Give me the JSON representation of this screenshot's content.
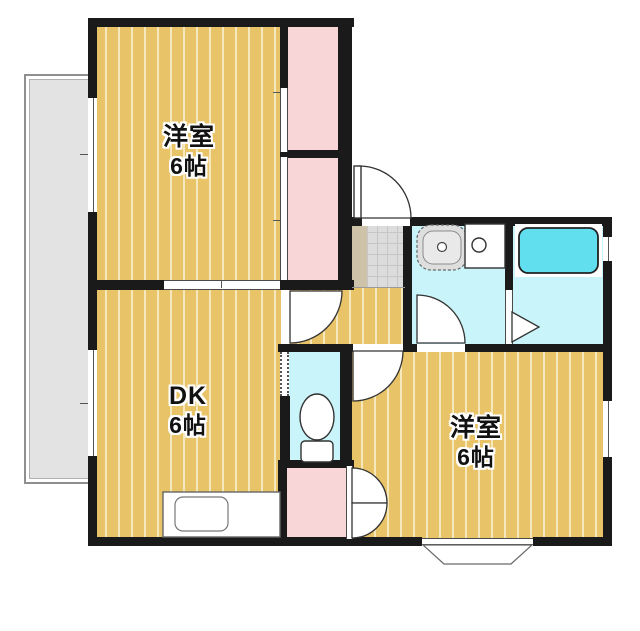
{
  "rooms": {
    "west_room_top": {
      "label": "洋室",
      "size": "6帖"
    },
    "dining_kitchen": {
      "label": "DK",
      "size": "6帖"
    },
    "west_room_bottom": {
      "label": "洋室",
      "size": "6帖"
    }
  },
  "fixtures": {
    "toilet": "toilet-fixture",
    "bathtub": "bathtub",
    "vanity_sink": "vanity-sink",
    "washing_machine": "washing-machine-pan",
    "kitchen_counter": "kitchen-counter-with-sink",
    "bay_window": "bay-window",
    "balcony": "balcony"
  },
  "colors": {
    "wall": "#1a1a1a",
    "wood_floor": "#e9c368",
    "wood_stripe": "#f6e8bd",
    "closet_pink": "#f8d6d8",
    "wet_area_cyan": "#c9f4fa",
    "bathtub_cyan": "#62dfee",
    "entry_tile_gray": "#dcdcdc",
    "entry_step_beige": "#cec2a8",
    "balcony_gray": "#e3e3e3"
  }
}
